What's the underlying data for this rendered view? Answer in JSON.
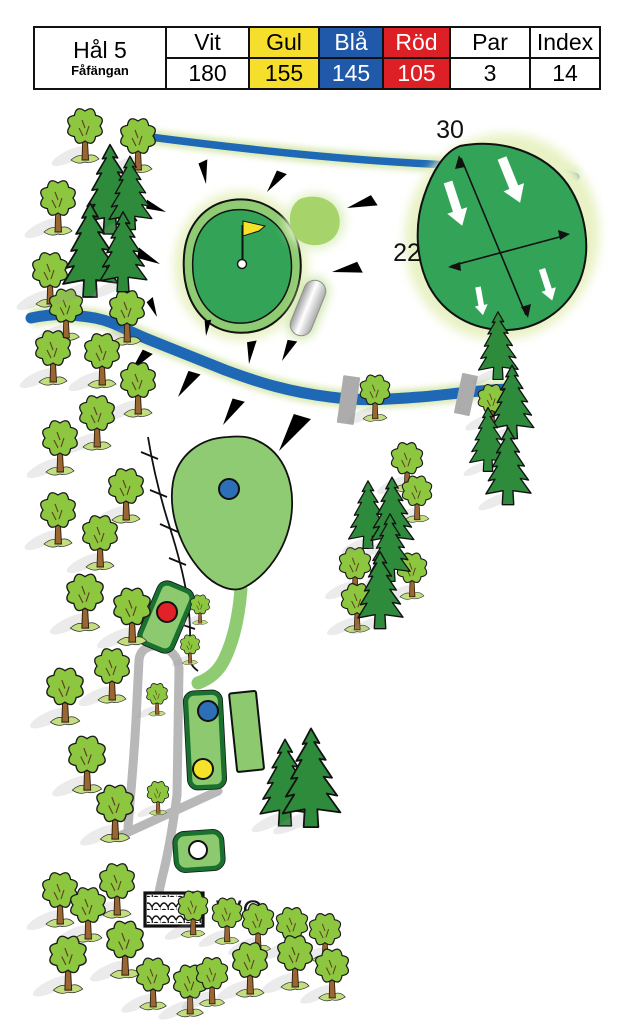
{
  "scorecard": {
    "hole_label": "Hål 5",
    "course_name": "Fåfängan",
    "cols": [
      {
        "label": "Vit",
        "value": "180",
        "bg": "#FFFFFF",
        "fg": "#000000"
      },
      {
        "label": "Gul",
        "value": "155",
        "bg": "#F6DE2D",
        "fg": "#000000"
      },
      {
        "label": "Blå",
        "value": "145",
        "bg": "#2059A9",
        "fg": "#FFFFFF"
      },
      {
        "label": "Röd",
        "value": "105",
        "bg": "#DD1F26",
        "fg": "#FFFFFF"
      },
      {
        "label": "Par",
        "value": "3",
        "bg": "#FFFFFF",
        "fg": "#000000"
      },
      {
        "label": "Index",
        "value": "14",
        "bg": "#FFFFFF",
        "fg": "#000000"
      }
    ]
  },
  "map": {
    "labels": {
      "green_depth": "30",
      "green_width": "22",
      "wc": "WC"
    },
    "colors": {
      "green": "#33A457",
      "fringe": "#8FCB72",
      "glow": "#E8F2C4",
      "fairway": "#8FCB72",
      "river": "#1E68B5",
      "path_gray": "#B8B8B8",
      "bridge_gray": "#ACACAC",
      "mound": "#A6D36A",
      "tee_fill": "#8CC96F",
      "tee_border": "#19702F",
      "tree_crown": "#8DC63F",
      "conifer": "#2E8B3B",
      "trunk": "#9A6733"
    },
    "tee_markers": [
      {
        "id": "red",
        "color": "#E32128"
      },
      {
        "id": "blue",
        "color": "#2D6FB7"
      },
      {
        "id": "yellow",
        "color": "#F5E32A"
      },
      {
        "id": "white",
        "color": "#FFFFFF"
      }
    ],
    "trees": {
      "deciduous": [
        [
          85,
          158,
          1
        ],
        [
          138,
          168,
          1
        ],
        [
          58,
          230,
          1
        ],
        [
          50,
          302,
          1
        ],
        [
          66,
          336,
          0.95
        ],
        [
          127,
          340,
          1
        ],
        [
          53,
          380,
          1
        ],
        [
          102,
          383,
          1
        ],
        [
          138,
          412,
          1
        ],
        [
          97,
          445,
          1
        ],
        [
          60,
          470,
          1
        ],
        [
          126,
          518,
          1
        ],
        [
          58,
          542,
          1
        ],
        [
          100,
          565,
          1
        ],
        [
          85,
          626,
          1.05
        ],
        [
          132,
          640,
          1.05
        ],
        [
          112,
          698,
          1
        ],
        [
          65,
          720,
          1.05
        ],
        [
          157,
          713,
          0.6
        ],
        [
          87,
          788,
          1.05
        ],
        [
          158,
          812,
          0.62
        ],
        [
          115,
          837,
          1.05
        ],
        [
          60,
          922,
          1
        ],
        [
          117,
          913,
          1
        ],
        [
          88,
          937,
          1
        ],
        [
          193,
          933,
          0.85
        ],
        [
          227,
          940,
          0.85
        ],
        [
          258,
          948,
          0.9
        ],
        [
          292,
          952,
          0.9
        ],
        [
          325,
          958,
          0.9
        ],
        [
          68,
          988,
          1.05
        ],
        [
          125,
          973,
          1.05
        ],
        [
          153,
          1005,
          0.95
        ],
        [
          190,
          1012,
          0.95
        ],
        [
          212,
          1002,
          0.9
        ],
        [
          250,
          992,
          1
        ],
        [
          295,
          985,
          1
        ],
        [
          332,
          996,
          0.95
        ],
        [
          200,
          622,
          0.55
        ],
        [
          190,
          662,
          0.55
        ],
        [
          375,
          417,
          0.85
        ],
        [
          407,
          487,
          0.9
        ],
        [
          417,
          518,
          0.85
        ],
        [
          355,
          592,
          0.9
        ],
        [
          412,
          595,
          0.85
        ],
        [
          357,
          628,
          0.9
        ],
        [
          492,
          424,
          0.8
        ]
      ],
      "conifer": [
        [
          110,
          232,
          0.95
        ],
        [
          130,
          228,
          0.78
        ],
        [
          90,
          295,
          1
        ],
        [
          123,
          290,
          0.85
        ],
        [
          498,
          378,
          0.72
        ],
        [
          512,
          437,
          0.78
        ],
        [
          488,
          470,
          0.68
        ],
        [
          508,
          503,
          0.82
        ],
        [
          368,
          547,
          0.72
        ],
        [
          392,
          549,
          0.78
        ],
        [
          390,
          580,
          0.72
        ],
        [
          380,
          627,
          0.82
        ],
        [
          285,
          824,
          0.92
        ],
        [
          311,
          825,
          1.05
        ]
      ]
    },
    "wedges": [
      [
        206,
        184,
        80,
        0.86
      ],
      [
        267,
        192,
        125,
        0.93
      ],
      [
        347,
        208,
        162,
        1.07
      ],
      [
        166,
        212,
        20,
        0.79
      ],
      [
        160,
        264,
        25,
        0.93
      ],
      [
        332,
        272,
        168,
        1.07
      ],
      [
        157,
        317,
        65,
        0.71
      ],
      [
        206,
        336,
        95,
        0.6
      ],
      [
        249,
        364,
        95,
        0.86
      ],
      [
        282,
        361,
        115,
        0.86
      ],
      [
        131,
        371,
        129,
        0.96
      ],
      [
        178,
        397,
        122,
        1.11
      ],
      [
        223,
        425,
        120,
        1.11
      ],
      [
        279,
        451,
        122,
        1.57
      ]
    ],
    "slope_arrows": [
      [
        448,
        182,
        72,
        1
      ],
      [
        502,
        158,
        68,
        1.05
      ],
      [
        478,
        287,
        80,
        0.62
      ],
      [
        542,
        269,
        72,
        0.72
      ]
    ]
  }
}
